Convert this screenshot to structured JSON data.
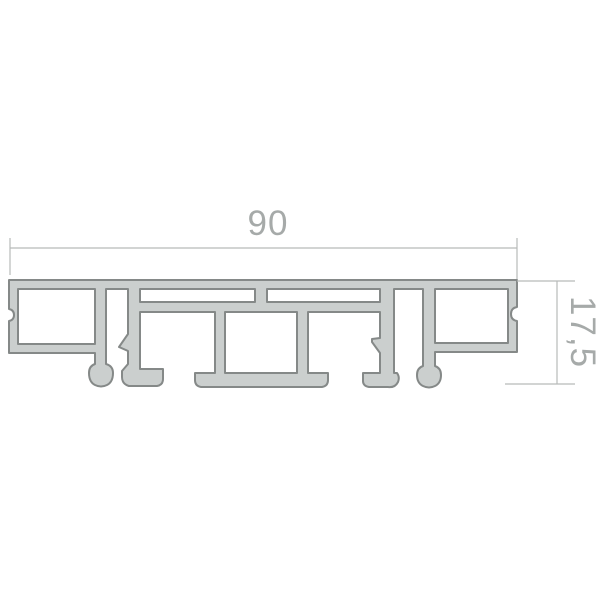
{
  "drawing": {
    "width_label": "90",
    "height_label": "17,5",
    "colors": {
      "profile_fill": "#cbcfce",
      "profile_stroke": "#858988",
      "dimension_line": "#b7bab9",
      "label_color": "#a6aaa9",
      "background": "#ffffff"
    }
  }
}
